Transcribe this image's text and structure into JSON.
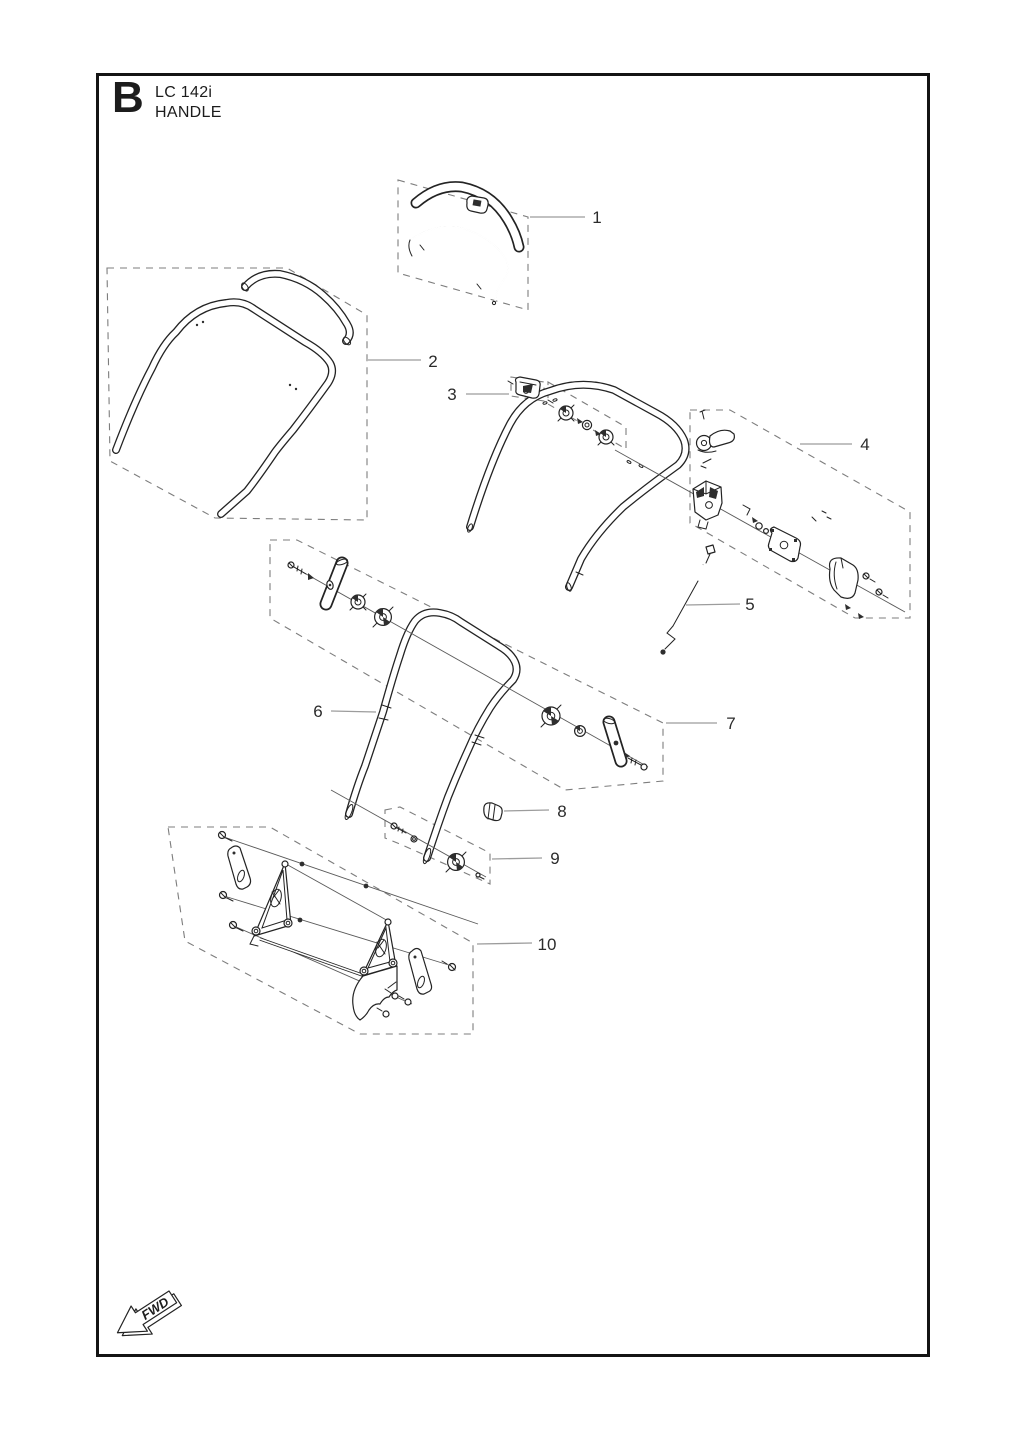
{
  "page": {
    "section_letter": "B",
    "model": "LC 142i",
    "section_title": "HANDLE",
    "fwd_label": "FWD"
  },
  "colors": {
    "ink": "#232323",
    "leader_line": "#9c9c9c",
    "dashed_box": "#7d7d7d",
    "background": "#ffffff"
  },
  "parts": [
    {
      "label": "1"
    },
    {
      "label": "2"
    },
    {
      "label": "3"
    },
    {
      "label": "4"
    },
    {
      "label": "5"
    },
    {
      "label": "6"
    },
    {
      "label": "7"
    },
    {
      "label": "8"
    },
    {
      "label": "9"
    },
    {
      "label": "10"
    }
  ]
}
